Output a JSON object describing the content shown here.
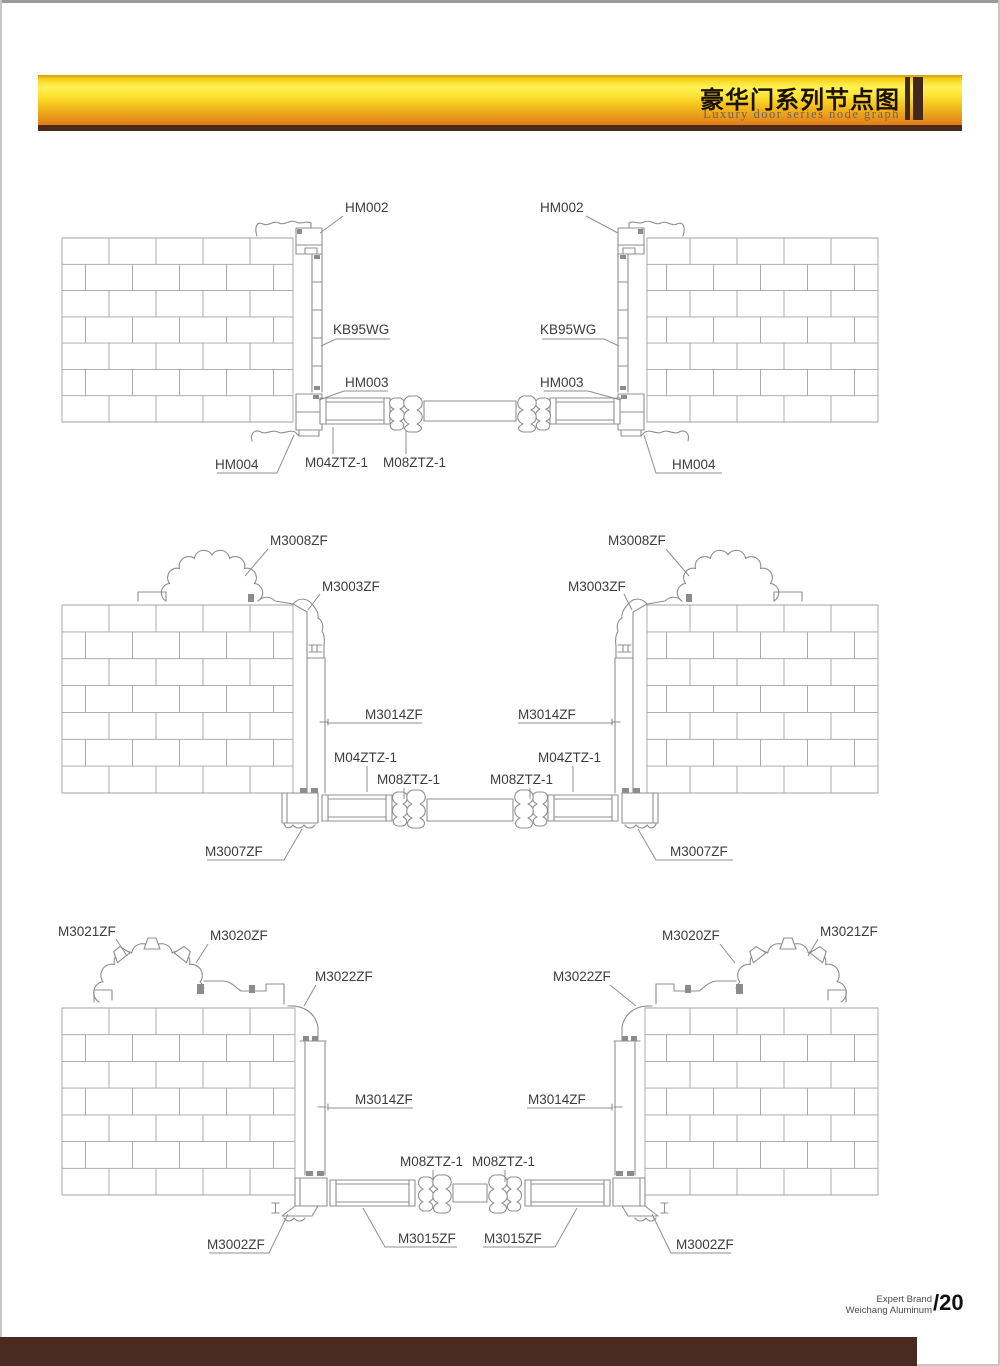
{
  "header": {
    "title_cn": "豪华门系列节点图",
    "subtitle_en": "Luxury door series node graph"
  },
  "footer": {
    "brand_line1": "Expert Brand",
    "brand_line2": "Weichang Aluminum",
    "page_number": "/20"
  },
  "colors": {
    "header_gold_top": "#d29c08",
    "header_gold_bright": "#fff155",
    "header_orange_bottom": "#e17b18",
    "header_underline_brown": "#4a2a1b",
    "bottom_bar_brown": "#4b2a21",
    "drawing_line_gray": "#8f8f8f",
    "label_text_gray": "#3d3d3d"
  },
  "diagrams": [
    {
      "id": "d1",
      "name": "door-frame-node-top",
      "labels": [
        {
          "t": "HM002",
          "x": 345,
          "y": 212,
          "lead": [
            [
              343,
              216
            ],
            [
              320,
              233
            ]
          ]
        },
        {
          "t": "HM002",
          "x": 540,
          "y": 212,
          "lead": [
            [
              586,
              216
            ],
            [
              618,
              233
            ]
          ]
        },
        {
          "t": "KB95WG",
          "x": 333,
          "y": 334,
          "lead": [
            [
              390,
              339
            ],
            [
              336,
              339
            ],
            [
              321,
              346
            ]
          ]
        },
        {
          "t": "KB95WG",
          "x": 540,
          "y": 334,
          "lead": [
            [
              542,
              339
            ],
            [
              604,
              339
            ],
            [
              619,
              346
            ]
          ]
        },
        {
          "t": "HM003",
          "x": 345,
          "y": 387,
          "lead": [
            [
              388,
              391
            ],
            [
              344,
              391
            ],
            [
              319,
              400
            ]
          ]
        },
        {
          "t": "HM003",
          "x": 540,
          "y": 387,
          "lead": [
            [
              544,
              391
            ],
            [
              588,
              391
            ],
            [
              621,
              400
            ]
          ]
        },
        {
          "t": "HM004",
          "x": 215,
          "y": 469,
          "lead": [
            [
              217,
              473
            ],
            [
              277,
              473
            ],
            [
              294,
              435
            ]
          ]
        },
        {
          "t": "HM004",
          "x": 672,
          "y": 469,
          "lead": [
            [
              722,
              473
            ],
            [
              656,
              473
            ],
            [
              644,
              435
            ]
          ]
        },
        {
          "t": "M04ZTZ-1",
          "x": 305,
          "y": 467,
          "lead": [
            [
              333,
              454
            ],
            [
              333,
              427
            ]
          ]
        },
        {
          "t": "M08ZTZ-1",
          "x": 383,
          "y": 467,
          "lead": [
            [
              406,
              454
            ],
            [
              406,
              431
            ]
          ]
        }
      ]
    },
    {
      "id": "d2",
      "name": "door-frame-node-middle",
      "labels": [
        {
          "t": "M3008ZF",
          "x": 270,
          "y": 545,
          "lead": [
            [
              268,
              549
            ],
            [
              245,
              576
            ]
          ]
        },
        {
          "t": "M3008ZF",
          "x": 608,
          "y": 545,
          "lead": [
            [
              666,
              549
            ],
            [
              689,
              576
            ]
          ]
        },
        {
          "t": "M3003ZF",
          "x": 322,
          "y": 591,
          "lead": [
            [
              320,
              594
            ],
            [
              308,
              610
            ]
          ]
        },
        {
          "t": "M3003ZF",
          "x": 568,
          "y": 591,
          "lead": [
            [
              624,
              594
            ],
            [
              632,
              610
            ]
          ]
        },
        {
          "t": "M3014ZF",
          "x": 365,
          "y": 719,
          "lead": [
            [
              422,
              723
            ],
            [
              327,
              723
            ]
          ]
        },
        {
          "t": "M3014ZF",
          "x": 518,
          "y": 719,
          "lead": [
            [
              518,
              723
            ],
            [
              613,
              723
            ]
          ]
        },
        {
          "t": "M04ZTZ-1",
          "x": 334,
          "y": 762,
          "lead": [
            [
              367,
              766
            ],
            [
              367,
              792
            ]
          ]
        },
        {
          "t": "M04ZTZ-1",
          "x": 538,
          "y": 762,
          "lead": [
            [
              573,
              766
            ],
            [
              573,
              792
            ]
          ]
        },
        {
          "t": "M08ZTZ-1",
          "x": 377,
          "y": 784,
          "lead": [
            [
              404,
              788
            ],
            [
              404,
              799
            ]
          ]
        },
        {
          "t": "M08ZTZ-1",
          "x": 490,
          "y": 784,
          "lead": [
            [
              530,
              788
            ],
            [
              530,
              799
            ]
          ]
        },
        {
          "t": "M3007ZF",
          "x": 205,
          "y": 856,
          "lead": [
            [
              207,
              860
            ],
            [
              284,
              860
            ],
            [
              302,
              829
            ]
          ]
        },
        {
          "t": "M3007ZF",
          "x": 670,
          "y": 856,
          "lead": [
            [
              733,
              860
            ],
            [
              656,
              860
            ],
            [
              638,
              829
            ]
          ]
        }
      ]
    },
    {
      "id": "d3",
      "name": "door-frame-node-bottom",
      "labels": [
        {
          "t": "M3021ZF",
          "x": 58,
          "y": 936,
          "lead": [
            [
              116,
              939
            ],
            [
              127,
              956
            ]
          ]
        },
        {
          "t": "M3021ZF",
          "x": 820,
          "y": 936,
          "lead": [
            [
              818,
              939
            ],
            [
              808,
              956
            ]
          ]
        },
        {
          "t": "M3020ZF",
          "x": 210,
          "y": 940,
          "lead": [
            [
              208,
              944
            ],
            [
              196,
              963
            ]
          ]
        },
        {
          "t": "M3020ZF",
          "x": 662,
          "y": 940,
          "lead": [
            [
              720,
              944
            ],
            [
              735,
              963
            ]
          ]
        },
        {
          "t": "M3022ZF",
          "x": 315,
          "y": 981,
          "lead": [
            [
              316,
              985
            ],
            [
              304,
              1006
            ]
          ]
        },
        {
          "t": "M3022ZF",
          "x": 553,
          "y": 981,
          "lead": [
            [
              610,
              985
            ],
            [
              636,
              1006
            ]
          ]
        },
        {
          "t": "M3014ZF",
          "x": 355,
          "y": 1104,
          "lead": [
            [
              413,
              1108
            ],
            [
              327,
              1108
            ]
          ]
        },
        {
          "t": "M3014ZF",
          "x": 528,
          "y": 1104,
          "lead": [
            [
              527,
              1108
            ],
            [
              613,
              1108
            ]
          ]
        },
        {
          "t": "M08ZTZ-1",
          "x": 400,
          "y": 1166,
          "lead": [
            [
              433,
              1170
            ],
            [
              433,
              1182
            ]
          ]
        },
        {
          "t": "M08ZTZ-1",
          "x": 472,
          "y": 1166,
          "lead": [
            [
              505,
              1170
            ],
            [
              505,
              1182
            ]
          ]
        },
        {
          "t": "M3015ZF",
          "x": 398,
          "y": 1243,
          "lead": [
            [
              457,
              1247
            ],
            [
              385,
              1247
            ],
            [
              363,
              1208
            ]
          ]
        },
        {
          "t": "M3015ZF",
          "x": 484,
          "y": 1243,
          "lead": [
            [
              483,
              1247
            ],
            [
              555,
              1247
            ],
            [
              577,
              1208
            ]
          ]
        },
        {
          "t": "M3002ZF",
          "x": 207,
          "y": 1249,
          "lead": [
            [
              209,
              1253
            ],
            [
              269,
              1253
            ],
            [
              288,
              1214
            ]
          ]
        },
        {
          "t": "M3002ZF",
          "x": 676,
          "y": 1249,
          "lead": [
            [
              731,
              1253
            ],
            [
              671,
              1253
            ],
            [
              652,
              1214
            ]
          ]
        }
      ]
    }
  ]
}
